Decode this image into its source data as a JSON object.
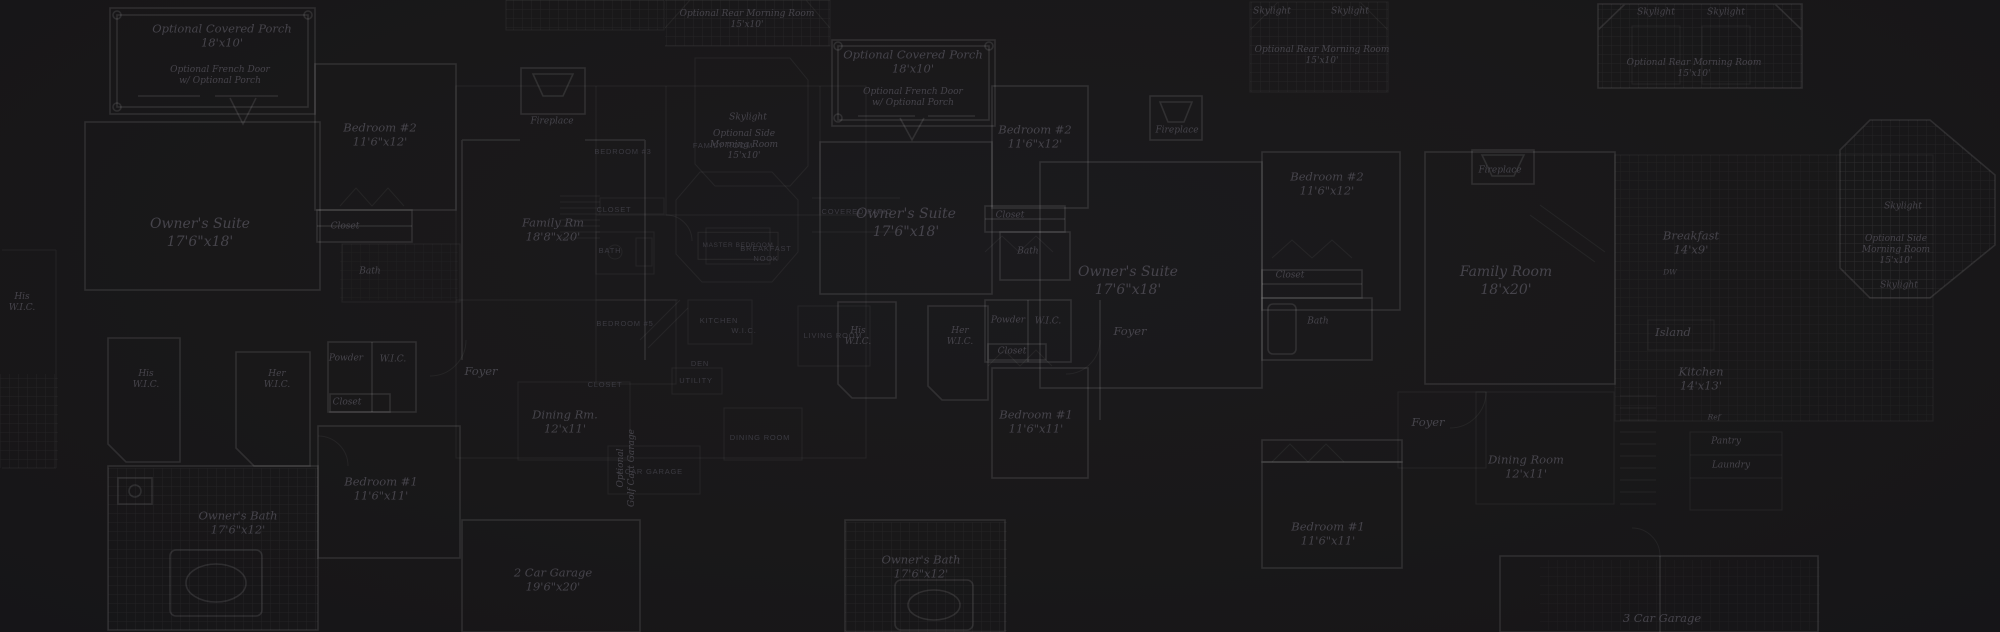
{
  "canvas": {
    "width": 2000,
    "height": 632,
    "background": "#191819"
  },
  "palette": {
    "wall_strong": "rgba(255,255,255,0.10)",
    "wall_faint": "rgba(255,255,255,0.055)",
    "hatch_line": "rgba(255,255,255,0.05)",
    "script_text": "#4a4850",
    "caps_text": "#3e3d45"
  },
  "plans": {
    "left_plan": {
      "labels": [
        {
          "name": "optional-covered-porch-label",
          "text": "Optional Covered Porch\n18'x10'",
          "x": 222,
          "y": 36,
          "style": "script-md"
        },
        {
          "name": "optional-french-door-label",
          "text": "Optional French Door\nw/ Optional Porch",
          "x": 220,
          "y": 76,
          "style": "script-sm"
        },
        {
          "name": "bedroom-2-label",
          "text": "Bedroom #2\n11'6\"x12'",
          "x": 380,
          "y": 135,
          "style": "script-md"
        },
        {
          "name": "owners-suite-label",
          "text": "Owner's Suite\n17'6\"x18'",
          "x": 200,
          "y": 233,
          "style": "script-lg"
        },
        {
          "name": "closet-label",
          "text": "Closet",
          "x": 345,
          "y": 227,
          "style": "script-sm"
        },
        {
          "name": "bath-label",
          "text": "Bath",
          "x": 370,
          "y": 272,
          "style": "script-sm"
        },
        {
          "name": "his-wic-label",
          "text": "His\nW.I.C.",
          "x": 146,
          "y": 380,
          "style": "script-sm"
        },
        {
          "name": "her-wic-label",
          "text": "Her\nW.I.C.",
          "x": 277,
          "y": 380,
          "style": "script-sm"
        },
        {
          "name": "powder-label",
          "text": "Powder",
          "x": 346,
          "y": 359,
          "style": "script-sm"
        },
        {
          "name": "wic-label",
          "text": "W.I.C.",
          "x": 393,
          "y": 360,
          "style": "script-sm"
        },
        {
          "name": "closet-2-label",
          "text": "Closet",
          "x": 347,
          "y": 403,
          "style": "script-sm"
        },
        {
          "name": "bedroom-1-label",
          "text": "Bedroom #1\n11'6\"x11'",
          "x": 381,
          "y": 489,
          "style": "script-md"
        },
        {
          "name": "owners-bath-label",
          "text": "Owner's Bath\n17'6\"x12'",
          "x": 238,
          "y": 523,
          "style": "script-md"
        },
        {
          "name": "family-rm-label",
          "text": "Family Rm\n18'8\"x20'",
          "x": 553,
          "y": 230,
          "style": "script-md"
        },
        {
          "name": "fireplace-label",
          "text": "Fireplace",
          "x": 552,
          "y": 122,
          "style": "script-sm"
        },
        {
          "name": "foyer-label",
          "text": "Foyer",
          "x": 481,
          "y": 371,
          "style": "script-md"
        },
        {
          "name": "dining-rm-label",
          "text": "Dining Rm.\n12'x11'",
          "x": 565,
          "y": 422,
          "style": "script-md"
        },
        {
          "name": "skylight-label",
          "text": "Skylight",
          "x": 748,
          "y": 118,
          "style": "script-sm"
        },
        {
          "name": "optional-side-morning-room-label",
          "text": "Optional Side\nMorning Room\n15'x10'",
          "x": 744,
          "y": 145,
          "style": "script-sm"
        },
        {
          "name": "optional-rear-morning-room-label",
          "text": "Optional Rear Morning Room\n15'x10'",
          "x": 747,
          "y": 20,
          "style": "script-sm"
        },
        {
          "name": "two-car-garage-label",
          "text": "2 Car Garage\n19'6\"x20'",
          "x": 553,
          "y": 580,
          "style": "script-md"
        },
        {
          "name": "optional-golf-cart-garage-label",
          "text": "Optional\nGolf Cart Garage",
          "x": 627,
          "y": 468,
          "style": "script-sm",
          "rot": true
        },
        {
          "name": "edge-his-wic-label",
          "text": "His\nW.I.C.",
          "x": 22,
          "y": 303,
          "style": "script-sm"
        }
      ]
    },
    "center_plan": {
      "labels": [
        {
          "name": "bedroom-3-label",
          "text": "BEDROOM #3",
          "x": 623,
          "y": 152,
          "style": "caps"
        },
        {
          "name": "family-room-label",
          "text": "FAMILY ROOM",
          "x": 723,
          "y": 146,
          "style": "caps"
        },
        {
          "name": "closet-label",
          "text": "CLOSET",
          "x": 614,
          "y": 210,
          "style": "caps"
        },
        {
          "name": "bath-label",
          "text": "BATH",
          "x": 610,
          "y": 251,
          "style": "caps"
        },
        {
          "name": "master-bedroom-label",
          "text": "MASTER BEDROOM",
          "x": 738,
          "y": 246,
          "style": "caps-box"
        },
        {
          "name": "bedroom-5-label",
          "text": "BEDROOM #5",
          "x": 625,
          "y": 324,
          "style": "caps"
        },
        {
          "name": "kitchen-label",
          "text": "KITCHEN",
          "x": 719,
          "y": 321,
          "style": "caps"
        },
        {
          "name": "breakfast-nook-label",
          "text": "BREAKFAST\nNOOK",
          "x": 766,
          "y": 254,
          "style": "caps"
        },
        {
          "name": "living-room-label",
          "text": "LIVING ROOM",
          "x": 833,
          "y": 336,
          "style": "caps"
        },
        {
          "name": "utility-label",
          "text": "UTILITY",
          "x": 696,
          "y": 381,
          "style": "caps"
        },
        {
          "name": "dining-room-label",
          "text": "DINING ROOM",
          "x": 760,
          "y": 438,
          "style": "caps"
        },
        {
          "name": "two-car-garage-label",
          "text": "2 CAR GARAGE",
          "x": 650,
          "y": 472,
          "style": "caps"
        },
        {
          "name": "covered-patio-label",
          "text": "COVERED PATIO",
          "x": 857,
          "y": 212,
          "style": "caps"
        },
        {
          "name": "closet-2-label",
          "text": "CLOSET",
          "x": 605,
          "y": 385,
          "style": "caps"
        },
        {
          "name": "den-label",
          "text": "DEN",
          "x": 700,
          "y": 364,
          "style": "caps"
        },
        {
          "name": "wic-label",
          "text": "W.I.C.",
          "x": 744,
          "y": 331,
          "style": "caps"
        }
      ]
    },
    "middle_plan": {
      "labels": [
        {
          "name": "optional-covered-porch-label",
          "text": "Optional Covered Porch\n18'x10'",
          "x": 913,
          "y": 62,
          "style": "script-md"
        },
        {
          "name": "optional-french-door-label",
          "text": "Optional French Door\nw/ Optional Porch",
          "x": 913,
          "y": 98,
          "style": "script-sm"
        },
        {
          "name": "owners-suite-label",
          "text": "Owner's Suite\n17'6\"x18'",
          "x": 906,
          "y": 223,
          "style": "script-lg"
        },
        {
          "name": "bedroom-2-label",
          "text": "Bedroom #2\n11'6\"x12'",
          "x": 1035,
          "y": 137,
          "style": "script-md"
        },
        {
          "name": "closet-label",
          "text": "Closet",
          "x": 1010,
          "y": 216,
          "style": "script-sm"
        },
        {
          "name": "bath-label",
          "text": "Bath",
          "x": 1028,
          "y": 252,
          "style": "script-sm"
        },
        {
          "name": "his-wic-label",
          "text": "His\nW.I.C.",
          "x": 858,
          "y": 337,
          "style": "script-sm"
        },
        {
          "name": "her-wic-label",
          "text": "Her\nW.I.C.",
          "x": 960,
          "y": 337,
          "style": "script-sm"
        },
        {
          "name": "powder-label",
          "text": "Powder",
          "x": 1008,
          "y": 321,
          "style": "script-sm"
        },
        {
          "name": "wic-label",
          "text": "W.I.C.",
          "x": 1048,
          "y": 322,
          "style": "script-sm"
        },
        {
          "name": "closet-2-label",
          "text": "Closet",
          "x": 1012,
          "y": 352,
          "style": "script-sm"
        },
        {
          "name": "bedroom-1-label",
          "text": "Bedroom #1\n11'6\"x11'",
          "x": 1036,
          "y": 422,
          "style": "script-md"
        },
        {
          "name": "owners-bath-label",
          "text": "Owner's Bath\n17'6\"x12'",
          "x": 921,
          "y": 567,
          "style": "script-md"
        },
        {
          "name": "foyer-label",
          "text": "Foyer",
          "x": 1130,
          "y": 331,
          "style": "script-md"
        },
        {
          "name": "fireplace-label",
          "text": "Fireplace",
          "x": 1177,
          "y": 131,
          "style": "script-sm"
        },
        {
          "name": "skylight-1-label",
          "text": "Skylight",
          "x": 1272,
          "y": 12,
          "style": "script-sm"
        },
        {
          "name": "skylight-2-label",
          "text": "Skylight",
          "x": 1350,
          "y": 12,
          "style": "script-sm"
        },
        {
          "name": "optional-rear-morning-room-label",
          "text": "Optional Rear Morning Room\n15'x10'",
          "x": 1322,
          "y": 56,
          "style": "script-sm"
        }
      ]
    },
    "right_plan": {
      "labels": [
        {
          "name": "skylight-1-label",
          "text": "Skylight",
          "x": 1656,
          "y": 13,
          "style": "script-sm"
        },
        {
          "name": "skylight-2-label",
          "text": "Skylight",
          "x": 1726,
          "y": 13,
          "style": "script-sm"
        },
        {
          "name": "optional-rear-morning-room-label",
          "text": "Optional Rear Morning Room\n15'x10'",
          "x": 1694,
          "y": 69,
          "style": "script-sm"
        },
        {
          "name": "fireplace-label",
          "text": "Fireplace",
          "x": 1500,
          "y": 171,
          "style": "script-sm"
        },
        {
          "name": "family-room-label",
          "text": "Family Room\n18'x20'",
          "x": 1506,
          "y": 281,
          "style": "script-lg"
        },
        {
          "name": "owners-suite-label",
          "text": "Owner's Suite\n17'6\"x18'",
          "x": 1128,
          "y": 281,
          "style": "script-lg"
        },
        {
          "name": "bedroom-2-label",
          "text": "Bedroom #2\n11'6\"x12'",
          "x": 1327,
          "y": 184,
          "style": "script-md"
        },
        {
          "name": "closet-label",
          "text": "Closet",
          "x": 1290,
          "y": 276,
          "style": "script-sm"
        },
        {
          "name": "bath-label",
          "text": "Bath",
          "x": 1318,
          "y": 322,
          "style": "script-sm"
        },
        {
          "name": "breakfast-label",
          "text": "Breakfast\n14'x9'",
          "x": 1691,
          "y": 243,
          "style": "script-md"
        },
        {
          "name": "dw-label",
          "text": "DW",
          "x": 1670,
          "y": 273,
          "style": "script-xs"
        },
        {
          "name": "island-label",
          "text": "Island",
          "x": 1673,
          "y": 332,
          "style": "script-md"
        },
        {
          "name": "kitchen-label",
          "text": "Kitchen\n14'x13'",
          "x": 1701,
          "y": 379,
          "style": "script-md"
        },
        {
          "name": "foyer-label",
          "text": "Foyer",
          "x": 1428,
          "y": 422,
          "style": "script-md"
        },
        {
          "name": "dining-room-label",
          "text": "Dining Room\n12'x11'",
          "x": 1526,
          "y": 467,
          "style": "script-md"
        },
        {
          "name": "ref-label",
          "text": "Ref",
          "x": 1714,
          "y": 418,
          "style": "script-xs"
        },
        {
          "name": "pantry-label",
          "text": "Pantry",
          "x": 1726,
          "y": 442,
          "style": "script-sm"
        },
        {
          "name": "laundry-label",
          "text": "Laundry",
          "x": 1731,
          "y": 466,
          "style": "script-sm"
        },
        {
          "name": "skylight-3-label",
          "text": "Skylight",
          "x": 1903,
          "y": 207,
          "style": "script-sm"
        },
        {
          "name": "optional-side-morning-room-label",
          "text": "Optional Side\nMorning Room\n15'x10'",
          "x": 1896,
          "y": 250,
          "style": "script-sm"
        },
        {
          "name": "skylight-4-label",
          "text": "Skylight",
          "x": 1899,
          "y": 286,
          "style": "script-sm"
        },
        {
          "name": "bedroom-1-label",
          "text": "Bedroom #1\n11'6\"x11'",
          "x": 1328,
          "y": 534,
          "style": "script-md"
        },
        {
          "name": "three-car-garage-label",
          "text": "3 Car Garage",
          "x": 1662,
          "y": 618,
          "style": "script-md"
        }
      ]
    }
  }
}
